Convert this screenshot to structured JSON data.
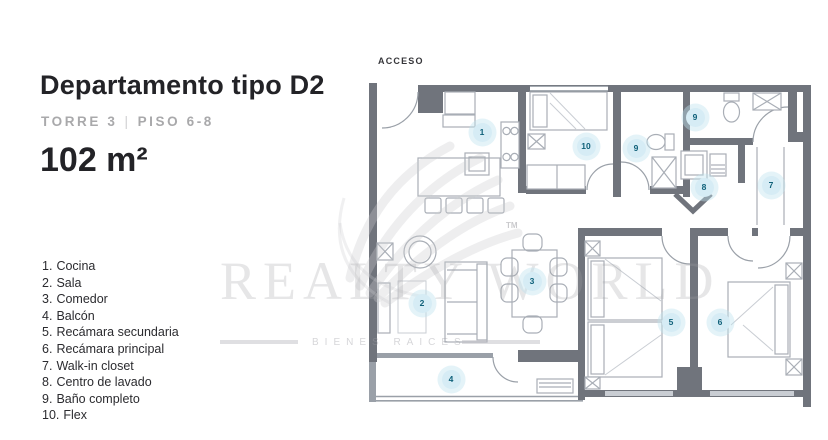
{
  "header": {
    "title": "Departamento tipo D2",
    "tower": "TORRE 3",
    "divider": "|",
    "floor": "PISO 6-8",
    "area": "102 m²"
  },
  "legend": [
    {
      "num": "1.",
      "label": "Cocina"
    },
    {
      "num": "2.",
      "label": "Sala"
    },
    {
      "num": "3.",
      "label": "Comedor"
    },
    {
      "num": "4.",
      "label": "Balcón"
    },
    {
      "num": "5.",
      "label": "Recámara secundaria"
    },
    {
      "num": "6.",
      "label": "Recámara principal"
    },
    {
      "num": "7.",
      "label": "Walk-in closet"
    },
    {
      "num": "8.",
      "label": "Centro de lavado"
    },
    {
      "num": "9.",
      "label": "Baño completo"
    },
    {
      "num": "10.",
      "label": "Flex"
    }
  ],
  "plan": {
    "access_label": "ACCESO",
    "markers": [
      "1",
      "2",
      "3",
      "4",
      "5",
      "6",
      "7",
      "8",
      "9",
      "9",
      "10"
    ]
  },
  "watermark": {
    "brand": "REALTY WORLD",
    "tm": "TM",
    "tagline": "BIENES RAICES"
  },
  "colors": {
    "wall": "#70747c",
    "wall_med": "#9aa0a8",
    "furniture": "#a9aeb6",
    "furniture_light": "#c9cdd3",
    "marker_fill": "#d6ecf5",
    "marker_text": "#0f6079",
    "text_dark": "#232327",
    "text_muted": "#a9a9ab",
    "watermark": "#c9c9cc"
  }
}
